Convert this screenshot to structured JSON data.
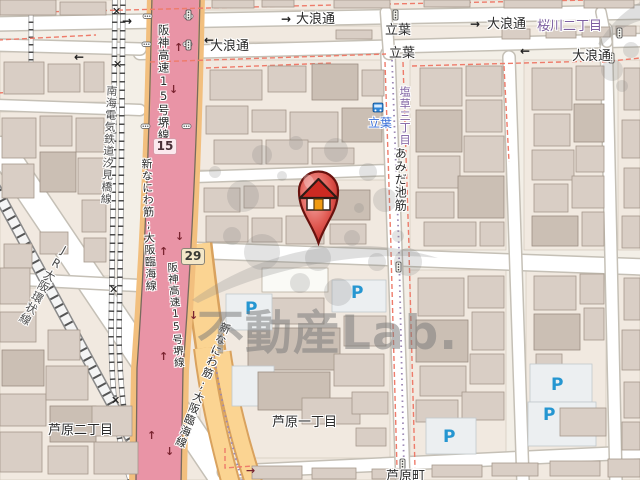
{
  "watermark": {
    "brand_text": "不動産Lab."
  },
  "roads": {
    "onami_dori": "大浪通",
    "amidaike_suji": "あみだ池筋",
    "hanshin_expressway_15_sakai": "阪神高速15号堺線",
    "shin_naniwa_osaka_rinkai": "新なにわ筋;大阪臨海線",
    "nankai_shiomibashi_line": "南海電気鉄道汐見橋線",
    "jr_osaka_loop_line": "JR大阪環状線"
  },
  "places": {
    "sakuragawa_2chome": "桜川二丁目",
    "shiokusa_3chome": "塩草三丁目",
    "tachiba": "立葉",
    "ashihara_2chome": "芦原二丁目",
    "ashihara_1chome": "芦原一丁目",
    "ashihara_cho": "芦原町"
  },
  "route_shields": {
    "hanshin_15": "15",
    "route_29": "29"
  },
  "map_icons": {
    "parking": "P",
    "rail_crossing": "✕"
  },
  "arrows": {
    "right": "→",
    "left": "←",
    "up": "↑",
    "down": "↓"
  },
  "colors": {
    "expressway_pink": "#e994a6",
    "expressway_casing_orange": "#f2bf7e",
    "road_orange": "#fbd492",
    "parking_blue": "#2596d1",
    "boundary_red_dashed": "#ee7b6a",
    "district_label_purple": "#7d5fa0",
    "bus_stop_blue": "#3a6fd8",
    "marker_red": "#cc2a22",
    "watermark_gray": "#7b7b7b"
  }
}
